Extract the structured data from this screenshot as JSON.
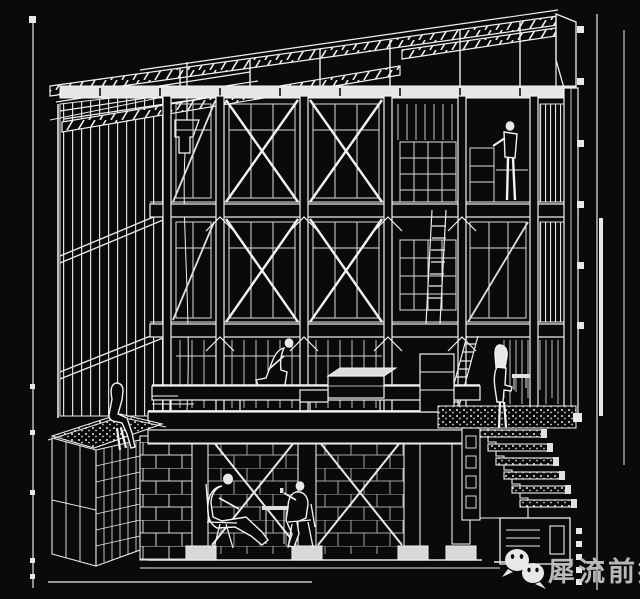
{
  "canvas": {
    "width": 640,
    "height": 599,
    "background": "#0a0a0a",
    "ink": "#f2f2f2"
  },
  "artwork": {
    "type": "black-and-white axonometric architectural section line drawing",
    "subject": "multi-storey timber-frame building section: sloped roof trusses, cross-braced window bays, mezzanine deck, planted ledge, basement lounge and descending stair",
    "figure_labels": [
      "person-on-upper-gallery",
      "seated-person-on-deck",
      "person-sitting-on-planted-ledge",
      "person-standing-at-stair-landing",
      "person-seated-in-basement-left",
      "person-seated-in-basement-right"
    ]
  },
  "watermark": {
    "text": "犀流前报",
    "text_color": "#c2c2c2",
    "icons": [
      {
        "name": "wechat-icon"
      },
      {
        "name": "wechat-icon"
      }
    ]
  }
}
